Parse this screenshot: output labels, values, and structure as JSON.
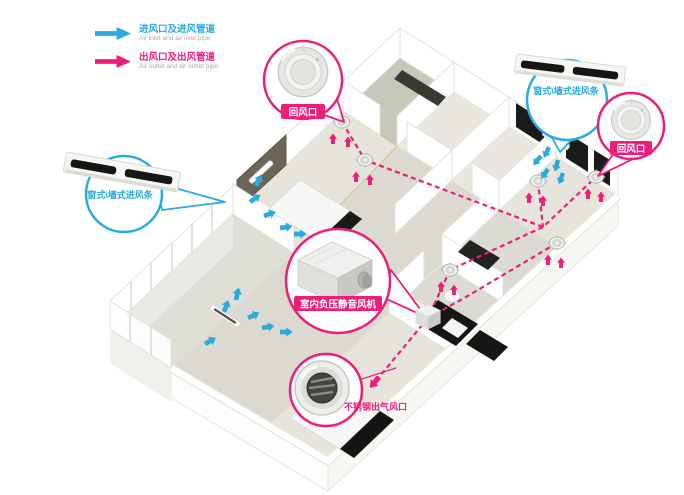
{
  "colors": {
    "inlet_blue": "#29ABE2",
    "outlet_pink": "#EC1E79"
  },
  "legend": {
    "inlet": {
      "zh": "进风口及进风管道",
      "en": "Air inlet and air inlet pipe"
    },
    "outlet": {
      "zh": "出风口及出风管道",
      "en": "Air outlet and air outlet pipe"
    }
  },
  "callouts": {
    "return_top": {
      "label": "回风口"
    },
    "inlet_strip_right": {
      "label": "窗式\\墙式进风条"
    },
    "return_right": {
      "label": "回风口"
    },
    "inlet_strip_left": {
      "label": "窗式\\墙式进风条"
    },
    "fan": {
      "label": "室内负压静音风机"
    },
    "outlet_bottom": {
      "label": "不锈钢出气风口"
    }
  },
  "icons": {
    "inlet_arrow": "blue-fat-arrow",
    "outlet_arrow": "pink-fat-arrow",
    "round_vent": "circular-return-air-vent",
    "slot_vent": "wall-slot-inlet-strip",
    "fan_unit": "negative-pressure-silent-fan-box",
    "steel_outlet": "stainless-steel-outlet-vent"
  }
}
